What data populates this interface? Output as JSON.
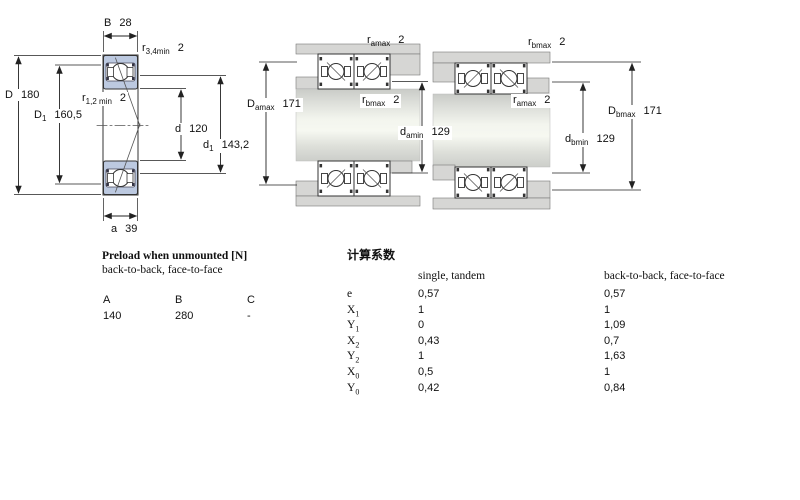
{
  "dims": {
    "b": {
      "sym": "B",
      "value": "28"
    },
    "r34": {
      "sym": "r",
      "sub": "3,4min",
      "value": "2"
    },
    "D": {
      "sym": "D",
      "value": "180"
    },
    "D1": {
      "sym": "D",
      "sub": "1",
      "value": "160,5"
    },
    "r12": {
      "sym": "r",
      "sub": "1,2 min",
      "value": "2"
    },
    "d": {
      "sym": "d",
      "value": "120"
    },
    "d1": {
      "sym": "d",
      "sub": "1",
      "value": "143,2"
    },
    "a": {
      "sym": "a",
      "value": "39"
    },
    "m_ra": {
      "sym": "r",
      "sub": "amax",
      "value": "2"
    },
    "m_Da": {
      "sym": "D",
      "sub": "amax",
      "value": "171"
    },
    "m_rb": {
      "sym": "r",
      "sub": "bmax",
      "value": "2"
    },
    "m_da": {
      "sym": "d",
      "sub": "amin",
      "value": "129"
    },
    "r_rb": {
      "sym": "r",
      "sub": "bmax",
      "value": "2"
    },
    "r_ra": {
      "sym": "r",
      "sub": "amax",
      "value": "2"
    },
    "r_db": {
      "sym": "d",
      "sub": "bmin",
      "value": "129"
    },
    "r_Db": {
      "sym": "D",
      "sub": "bmax",
      "value": "171"
    }
  },
  "preload_table": {
    "title": "Preload when unmounted [N]",
    "subtitle": "back-to-back, face-to-face",
    "columns": [
      "A",
      "B",
      "C"
    ],
    "values": [
      "140",
      "280",
      "-"
    ]
  },
  "factors_table": {
    "title": "计算系数",
    "col1_header": "single, tandem",
    "col2_header": "back-to-back, face-to-face",
    "rows": [
      {
        "sym": "e",
        "sub": "",
        "v1": "0,57",
        "v2": "0,57"
      },
      {
        "sym": "X",
        "sub": "1",
        "v1": "1",
        "v2": "1"
      },
      {
        "sym": "Y",
        "sub": "1",
        "v1": "0",
        "v2": "1,09"
      },
      {
        "sym": "X",
        "sub": "2",
        "v1": "0,43",
        "v2": "0,7"
      },
      {
        "sym": "Y",
        "sub": "2",
        "v1": "1",
        "v2": "1,63"
      },
      {
        "sym": "X",
        "sub": "0",
        "v1": "0,5",
        "v2": "1"
      },
      {
        "sym": "Y",
        "sub": "0",
        "v1": "0,42",
        "v2": "0,84"
      }
    ]
  },
  "colors": {
    "bearing_blue": "#bcc9e0",
    "steel_gray": "#d6d6d4",
    "line": "#222222"
  }
}
